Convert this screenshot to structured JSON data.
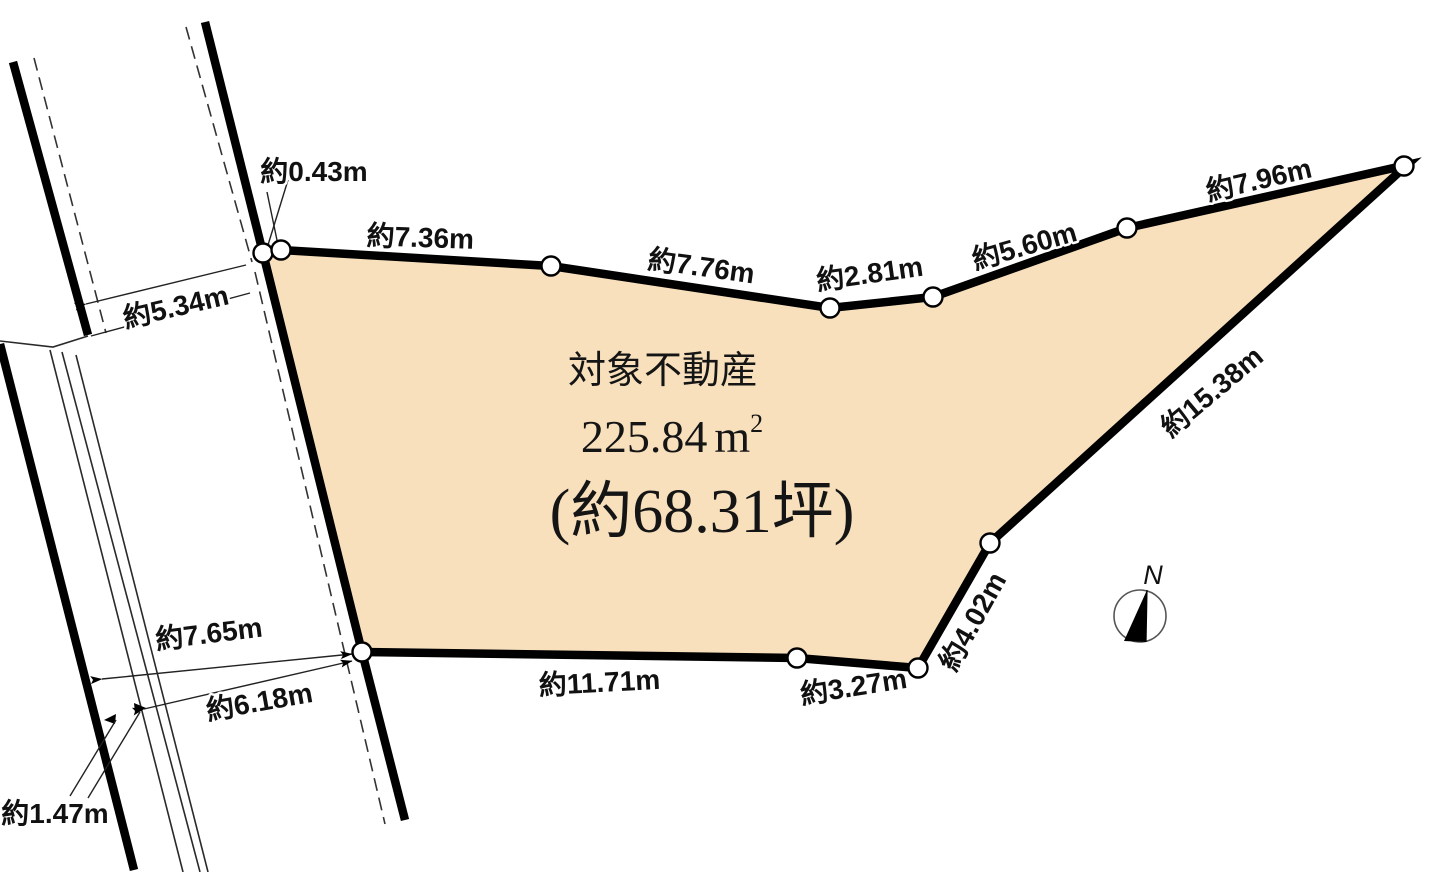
{
  "diagram_title": "土地区画図",
  "parcel": {
    "label": "対象不動産",
    "area_value": "225.84",
    "area_unit_base": "m",
    "area_unit_sup": "2",
    "area_tsubo": "(約68.31坪)"
  },
  "dimensions": {
    "d0_43": "約0.43m",
    "d7_36": "約7.36m",
    "d7_76": "約7.76m",
    "d2_81": "約2.81m",
    "d5_60": "約5.60m",
    "d7_96": "約7.96m",
    "d15_38": "約15.38m",
    "d4_02": "約4.02m",
    "d3_27": "約3.27m",
    "d11_71": "約11.71m",
    "d5_34": "約5.34m",
    "d7_65": "約7.65m",
    "d6_18": "約6.18m",
    "d1_47": "約1.47m"
  },
  "compass": {
    "north_label": "N"
  },
  "colors": {
    "parcel_fill": "#F8E0BD",
    "line_color": "#000000"
  }
}
